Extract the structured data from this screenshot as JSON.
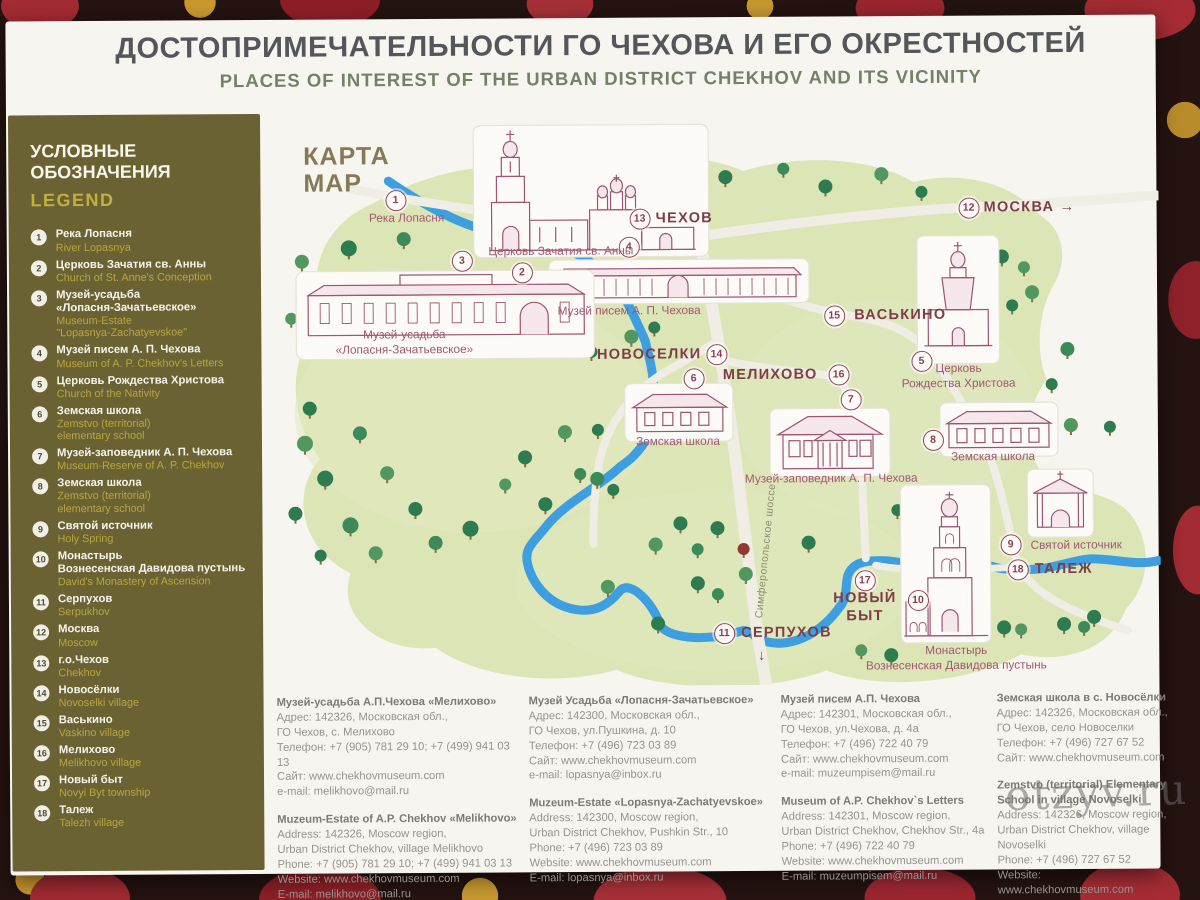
{
  "header": {
    "title_ru": "ДОСТОПРИМЕЧАТЕЛЬНОСТИ ГО ЧЕХОВА И ЕГО ОКРЕСТНОСТЕЙ",
    "title_en": "PLACES OF INTEREST OF THE URBAN DISTRICT CHEKHOV AND ITS VICINITY"
  },
  "colors": {
    "legend_bg": "#6b6233",
    "legend_accent": "#c1b040",
    "map_terrain": "#dbe5b6",
    "river_blue": "#3d9ee0",
    "landmark_maroon": "#9d5570",
    "town_label": "#7e3c49"
  },
  "legend": {
    "heading_ru": "УСЛОВНЫЕ\nОБОЗНАЧЕНИЯ",
    "heading_en": "LEGEND",
    "items": [
      {
        "num": "1",
        "ru": "Река Лопасня",
        "en": "River Lopasnya"
      },
      {
        "num": "2",
        "ru": "Церковь Зачатия св. Анны",
        "en": "Church of St. Anne's Conception"
      },
      {
        "num": "3",
        "ru": "Музей-усадьба\n«Лопасня-Зачатьевское»",
        "en": "Museum-Estate\n\"Lopasnya-Zachatyevskoe\""
      },
      {
        "num": "4",
        "ru": "Музей писем А. П. Чехова",
        "en": "Museum of A. P. Chekhov's Letters"
      },
      {
        "num": "5",
        "ru": "Церковь Рождества Христова",
        "en": "Church of the Nativity"
      },
      {
        "num": "6",
        "ru": "Земская школа",
        "en": "Zemstvo (territorial)\nelementary school"
      },
      {
        "num": "7",
        "ru": "Музей-заповедник А. П. Чехова",
        "en": "Museum-Reserve of A. P. Chekhov"
      },
      {
        "num": "8",
        "ru": "Земская школа",
        "en": "Zemstvo (territorial)\nelementary school"
      },
      {
        "num": "9",
        "ru": "Святой источник",
        "en": "Holy Spring"
      },
      {
        "num": "10",
        "ru": "Монастырь\nВознесенская Давидова пустынь",
        "en": "David's Monastery of Ascension"
      },
      {
        "num": "11",
        "ru": "Серпухов",
        "en": "Serpukhov"
      },
      {
        "num": "12",
        "ru": "Москва",
        "en": "Moscow"
      },
      {
        "num": "13",
        "ru": "г.о.Чехов",
        "en": "Chekhov"
      },
      {
        "num": "14",
        "ru": "Новосёлки",
        "en": "Novoselki village"
      },
      {
        "num": "15",
        "ru": "Васькино",
        "en": "Vaskino village"
      },
      {
        "num": "16",
        "ru": "Мелихово",
        "en": "Melikhovo village"
      },
      {
        "num": "17",
        "ru": "Новый быт",
        "en": "Novyi Byt township"
      },
      {
        "num": "18",
        "ru": "Талеж",
        "en": "Talezh village"
      }
    ]
  },
  "map": {
    "label_ru": "КАРТА",
    "label_en": "MAP",
    "markers": [
      {
        "num": "1",
        "x": 132,
        "y": 87
      },
      {
        "num": "2",
        "x": 258,
        "y": 160
      },
      {
        "num": "3",
        "x": 198,
        "y": 148
      },
      {
        "num": "4",
        "x": 365,
        "y": 135
      },
      {
        "num": "5",
        "x": 657,
        "y": 251
      },
      {
        "num": "6",
        "x": 429,
        "y": 267
      },
      {
        "num": "7",
        "x": 586,
        "y": 289
      },
      {
        "num": "8",
        "x": 668,
        "y": 330
      },
      {
        "num": "9",
        "x": 745,
        "y": 435
      },
      {
        "num": "10",
        "x": 652,
        "y": 490
      },
      {
        "num": "11",
        "x": 458,
        "y": 522
      },
      {
        "num": "12",
        "x": 705,
        "y": 98
      },
      {
        "num": "13",
        "x": 376,
        "y": 107
      },
      {
        "num": "14",
        "x": 452,
        "y": 243
      },
      {
        "num": "15",
        "x": 570,
        "y": 205
      },
      {
        "num": "16",
        "x": 574,
        "y": 264
      },
      {
        "num": "17",
        "x": 599,
        "y": 470
      },
      {
        "num": "18",
        "x": 752,
        "y": 460
      }
    ],
    "labels": [
      {
        "text": "Река Лопасня",
        "x": 143,
        "y": 105,
        "type": "site",
        "anchor": "center"
      },
      {
        "text": "Церковь Зачатия св. Анны",
        "x": 297,
        "y": 139,
        "type": "site",
        "anchor": "center"
      },
      {
        "text": "Музей писем А. П. Чехова",
        "x": 365,
        "y": 199,
        "type": "site",
        "anchor": "center"
      },
      {
        "text": "Музей-усадьба\n«Лопасня-Зачатьевское»",
        "x": 140,
        "y": 229,
        "type": "site",
        "anchor": "center"
      },
      {
        "text": "ЧЕХОВ",
        "x": 392,
        "y": 107,
        "type": "town",
        "anchor": "start"
      },
      {
        "text": "МОСКВА →",
        "x": 720,
        "y": 98,
        "type": "town",
        "anchor": "start"
      },
      {
        "text": "ВАСЬКИНО",
        "x": 590,
        "y": 205,
        "type": "town",
        "anchor": "start"
      },
      {
        "text": "НОВОСЕЛКИ",
        "x": 437,
        "y": 243,
        "type": "town",
        "anchor": "end"
      },
      {
        "text": "МЕЛИХОВО",
        "x": 553,
        "y": 264,
        "type": "town",
        "anchor": "end"
      },
      {
        "text": "Церковь\nРождества Христова",
        "x": 694,
        "y": 266,
        "type": "site",
        "anchor": "center"
      },
      {
        "text": "Земская школа",
        "x": 413,
        "y": 330,
        "type": "site",
        "anchor": "center"
      },
      {
        "text": "Музей-заповедник А. П. Чехова",
        "x": 566,
        "y": 368,
        "type": "site",
        "anchor": "center"
      },
      {
        "text": "Земская школа",
        "x": 728,
        "y": 347,
        "type": "site",
        "anchor": "center"
      },
      {
        "text": "Святой источник",
        "x": 765,
        "y": 436,
        "type": "site",
        "anchor": "start"
      },
      {
        "text": "ТАЛЕЖ",
        "x": 769,
        "y": 460,
        "type": "town",
        "anchor": "start"
      },
      {
        "text": "НОВЫЙ\nБЫТ",
        "x": 599,
        "y": 497,
        "type": "town",
        "anchor": "center"
      },
      {
        "text": "СЕРПУХОВ",
        "x": 475,
        "y": 522,
        "type": "town",
        "anchor": "start"
      },
      {
        "text": "↓",
        "x": 496,
        "y": 545,
        "type": "town",
        "anchor": "center"
      },
      {
        "text": "Монастырь\nВознесенская Давидова пустынь",
        "x": 690,
        "y": 548,
        "type": "site",
        "anchor": "center"
      },
      {
        "text": "Симферопольское шоссе",
        "x": 500,
        "y": 440,
        "type": "road",
        "anchor": "center",
        "rotate": -84
      }
    ]
  },
  "contacts": [
    {
      "ru_title": "Музей-усадьба А.П.Чехова «Мелихово»",
      "ru_lines": "Адрес: 142326, Московская обл.,\nГО Чехов, с. Мелихово\nТелефон: +7 (905) 781 29 10; +7 (499) 941 03 13\nСайт: www.chekhovmuseum.com\ne-mail: melikhovo@mail.ru",
      "en_title": "Muzeum-Estate of A.P. Chekhov «Melikhovo»",
      "en_lines": "Address: 142326, Moscow region,\nUrban District Chekhov, village Melikhovo\nPhone: +7 (905) 781 29 10; +7 (499) 941 03 13\nWebsite: www.chekhovmuseum.com\nE-mail: melikhovo@mail.ru"
    },
    {
      "ru_title": "Музей Усадьба «Лопасня-Зачатьевское»",
      "ru_lines": "Адрес: 142300, Московская обл.,\nГО Чехов, ул.Пушкина, д. 10\nТелефон: +7 (496) 723 03 89\nСайт: www.chekhovmuseum.com\ne-mail: lopasnya@inbox.ru",
      "en_title": "Muzeum-Estate «Lopasnya-Zachatyevskoe»",
      "en_lines": "Address: 142300, Moscow region,\nUrban District Chekhov, Pushkin Str., 10\nPhone: +7 (496) 723 03 89\nWebsite: www.chekhovmuseum.com\nE-mail: lopasnya@inbox.ru"
    },
    {
      "ru_title": "Музей писем А.П. Чехова",
      "ru_lines": "Адрес: 142301, Московская обл.,\nГО Чехов, ул.Чехова, д. 4а\nТелефон: +7 (496) 722 40 79\nСайт: www.chekhovmuseum.com\ne-mail: muzeumpisem@mail.ru",
      "en_title": "Museum of A.P. Chekhov`s Letters",
      "en_lines": "Address: 142301, Moscow region,\nUrban District Chekhov, Chekhov Str., 4a\nPhone: +7 (496) 722 40 79\nWebsite: www.chekhovmuseum.com\nE-mail: muzeumpisem@mail.ru"
    },
    {
      "ru_title": "Земская школа в с. Новосёлки",
      "ru_lines": "Адрес: 142326, Московская обл.,\nГО Чехов, село Новоселки\nТелефон: +7 (496) 727 67 52\nСайт: www.chekhovmuseum.com",
      "en_title": "Zemstvo (territorial) Elementary School in village Novoselki",
      "en_lines": "Address: 142326, Moscow region,\nUrban District Chekhov, village Novoselki\nPhone: +7 (496) 727 67 52\nWebsite: www.chekhovmuseum.com"
    }
  ],
  "watermark": {
    "text": "otzyv.ru"
  }
}
